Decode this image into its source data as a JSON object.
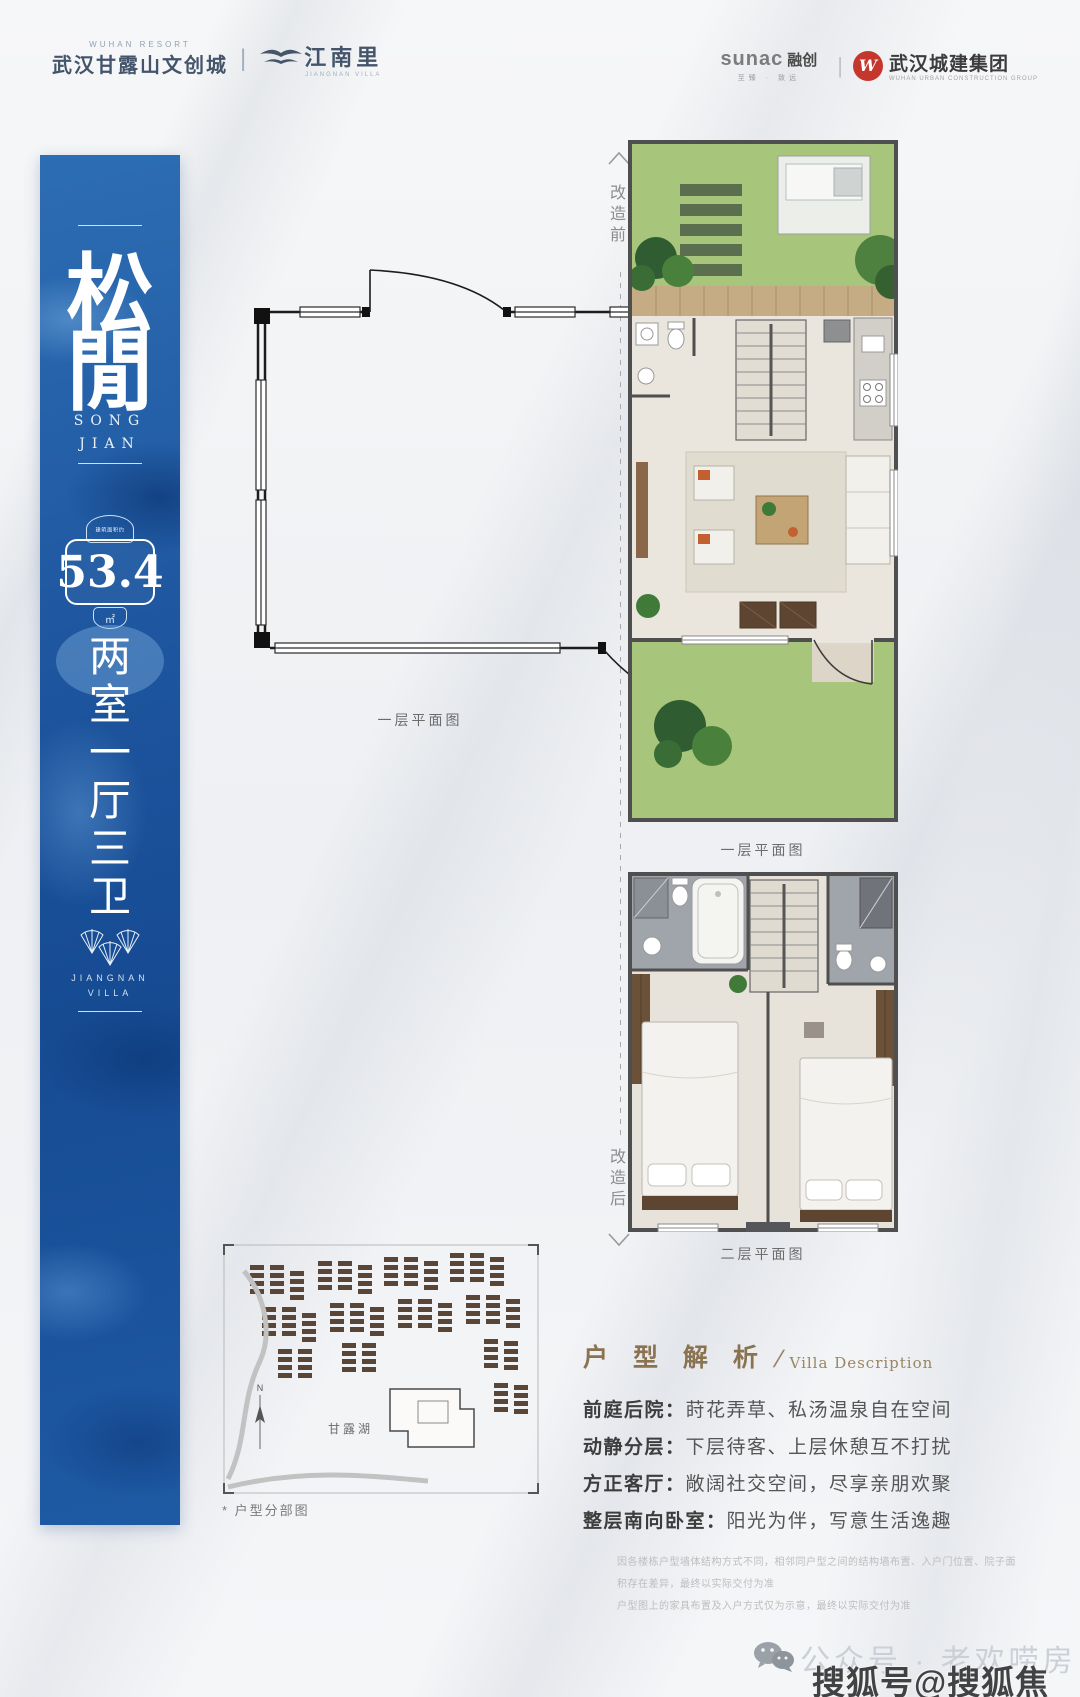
{
  "header": {
    "resort_small": "WUHAN RESORT",
    "resort_name": "武汉甘露山文创城",
    "separator": "|",
    "brand_name": "江南里",
    "brand_sub": "JIANGNAN VILLA",
    "sunac_en": "sunac",
    "sunac_cn": "融创",
    "sunac_slogan": "至臻 · 致远",
    "builder_logo_letter": "W",
    "builder_name": "武汉城建集团",
    "builder_sub": "WUHAN URBAN CONSTRUCTION GROUP"
  },
  "banner": {
    "title_char_1": "松",
    "title_char_2": "閒",
    "title_en_1": "SONG",
    "title_en_2": "JIAN",
    "area_label": "建筑面积约",
    "area_value": "53.4",
    "area_unit": "㎡",
    "layout_chars": [
      "两",
      "室",
      "一",
      "厅",
      "三",
      "卫"
    ],
    "villa_en_1": "JIANGNAN",
    "villa_en_2": "VILLA"
  },
  "plans": {
    "before_label": "改造前",
    "after_label": "改造后",
    "original_caption": "一层平面图",
    "floor1_caption": "一层平面图",
    "floor2_caption": "二层平面图"
  },
  "sitemap": {
    "caption": "* 户型分部图",
    "lake_label": "甘露湖",
    "compass_n": "N"
  },
  "description": {
    "title_cn": "户 型 解 析",
    "title_slash": "/",
    "title_en": "Villa Description",
    "items": [
      {
        "head": "前庭后院：",
        "body": "莳花弄草、私汤温泉自在空间"
      },
      {
        "head": "动静分层：",
        "body": "下层待客、上层休憩互不打扰"
      },
      {
        "head": "方正客厅：",
        "body": "敞阔社交空间，尽享亲朋欢聚"
      },
      {
        "head": "整层南向卧室：",
        "body": "阳光为伴，写意生活逸趣"
      }
    ],
    "disclaimer_1": "因各楼栋户型墙体结构方式不同，相邻同户型之间的结构墙布置、入户门位置、院子面积存在差异，最终以实际交付为准",
    "disclaimer_2": "户型图上的家具布置及入户方式仅为示意，最终以实际交付为准"
  },
  "footer": {
    "wechat_label": "公众号 · 老欢唠房",
    "watermark": "搜狐号@搜狐焦点铜川站"
  },
  "colors": {
    "banner_blue": "#1d559e",
    "garden_green": "#a7c57b",
    "deck_wood": "#c6ac84",
    "interior_floor": "#ebe6dd",
    "tile_gray": "#a0a4ab",
    "furniture_brown": "#6a5138",
    "accent_orange": "#c2602f",
    "title_bronze": "#8a7350",
    "builder_red": "#c5372c"
  }
}
